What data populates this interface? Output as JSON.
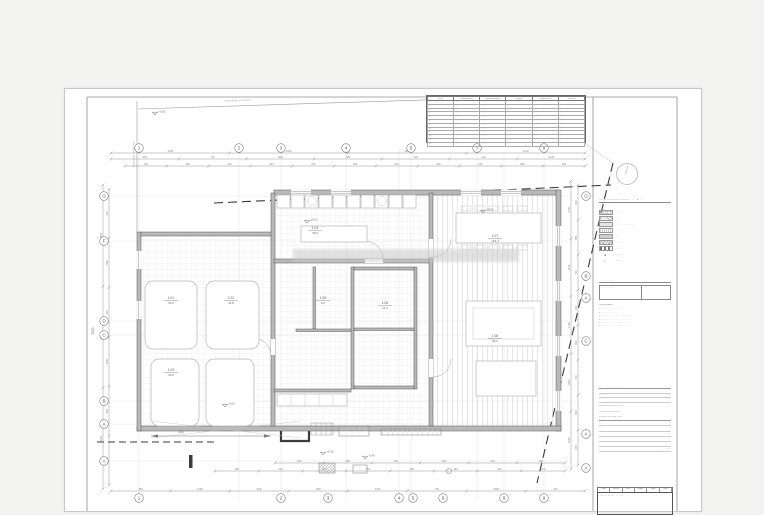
{
  "page": {
    "bg": "#f3f3f2",
    "sheet_bg": "#ffffff",
    "line_color": "#555555",
    "grid_color": "#dcdcdc",
    "dash_color": "#3a3a3a"
  },
  "plan": {
    "boundary_label": "граница участка",
    "grid": {
      "vlines": [
        74,
        174,
        216,
        281,
        334,
        346,
        412,
        439,
        479
      ],
      "hlines": [
        107,
        152,
        232,
        246,
        312,
        335,
        372
      ],
      "top": [
        {
          "x": 74,
          "label": "1"
        },
        {
          "x": 174,
          "label": "2"
        },
        {
          "x": 216,
          "label": "3"
        },
        {
          "x": 281,
          "label": "4"
        },
        {
          "x": 346,
          "label": "5"
        },
        {
          "x": 412,
          "label": "7"
        },
        {
          "x": 479,
          "label": "9"
        }
      ],
      "bottom": [
        {
          "x": 74,
          "label": "1"
        },
        {
          "x": 216,
          "label": "2"
        },
        {
          "x": 263,
          "label": "3"
        },
        {
          "x": 334,
          "label": "4"
        },
        {
          "x": 348,
          "label": "5"
        },
        {
          "x": 378,
          "label": "6"
        },
        {
          "x": 439,
          "label": "8"
        },
        {
          "x": 479,
          "label": "9"
        }
      ],
      "left": [
        {
          "y": 107,
          "label": "G"
        },
        {
          "y": 152,
          "label": "F"
        },
        {
          "y": 232,
          "label": "D"
        },
        {
          "y": 246,
          "label": "C"
        },
        {
          "y": 312,
          "label": "B"
        },
        {
          "y": 335,
          "label": "A"
        },
        {
          "y": 372,
          "label": "A"
        }
      ],
      "right": [
        {
          "y": 107,
          "label": "G"
        },
        {
          "y": 187,
          "label": "B"
        },
        {
          "y": 209,
          "label": "A"
        },
        {
          "y": 252,
          "label": "C"
        },
        {
          "y": 345,
          "label": "A"
        },
        {
          "y": 379,
          "label": "A"
        }
      ]
    },
    "dims": [
      {
        "o": "h",
        "y": 64,
        "x1": 46,
        "x2": 520,
        "vals": [
          "1245",
          "3300",
          "2890",
          "4120"
        ]
      },
      {
        "o": "h",
        "y": 70,
        "x1": 46,
        "x2": 520,
        "vals": [
          "350",
          "740",
          "1650",
          "830",
          "645",
          "410",
          "1245"
        ]
      },
      {
        "o": "h",
        "y": 77,
        "x1": 60,
        "x2": 520,
        "vals": [
          "120",
          "340",
          "510",
          "280",
          "420",
          "330",
          "510",
          "260",
          "340",
          "450",
          "300"
        ]
      },
      {
        "o": "h",
        "y": 374,
        "x1": 210,
        "x2": 500,
        "vals": [
          "420",
          "180",
          "260",
          "300",
          "240",
          "380"
        ]
      },
      {
        "o": "h",
        "y": 382,
        "x1": 150,
        "x2": 500,
        "vals": [
          "300",
          "510",
          "420",
          "360",
          "280",
          "440",
          "330",
          "270"
        ]
      },
      {
        "o": "h",
        "y": 402,
        "x1": 46,
        "x2": 520,
        "vals": [
          "980",
          "1460",
          "1020",
          "880",
          "1240",
          "760",
          "1080",
          "940"
        ]
      },
      {
        "o": "v",
        "x": 38,
        "y1": 96,
        "y2": 400,
        "vals": [
          "2850",
          "4320",
          "3940"
        ]
      },
      {
        "o": "v",
        "x": 44,
        "y1": 100,
        "y2": 396,
        "vals": [
          "760",
          "1180",
          "920",
          "1040",
          "860",
          "1120"
        ]
      },
      {
        "o": "v",
        "x": 506,
        "y1": 92,
        "y2": 380,
        "vals": [
          "1540",
          "2120",
          "1780",
          "1460",
          "1920"
        ]
      },
      {
        "o": "v",
        "x": 513,
        "y1": 96,
        "y2": 376,
        "vals": [
          "620",
          "880",
          "740",
          "810",
          "690",
          "720",
          "830",
          "650"
        ]
      }
    ],
    "special_dims": [
      {
        "x": 116,
        "y": 344,
        "label": "300",
        "rot": 0
      },
      {
        "x": 29,
        "y": 242,
        "label": "1500",
        "rot": -90
      }
    ],
    "rooms": [
      {
        "x": 106,
        "y": 210,
        "no": "1.01",
        "area": "35,2"
      },
      {
        "x": 166,
        "y": 210,
        "no": "1.02",
        "area": "34,8"
      },
      {
        "x": 106,
        "y": 282,
        "no": "1.03",
        "area": "33,6"
      },
      {
        "x": 250,
        "y": 140,
        "no": "1.04",
        "area": "38,6"
      },
      {
        "x": 258,
        "y": 210,
        "no": "1.05",
        "area": "6,2"
      },
      {
        "x": 320,
        "y": 215,
        "no": "1.06",
        "area": "12,4"
      },
      {
        "x": 430,
        "y": 148,
        "no": "1.07",
        "area": "164,4"
      },
      {
        "x": 430,
        "y": 248,
        "no": "1.08",
        "area": "56,0"
      }
    ],
    "elevations": [
      {
        "x": 90,
        "y": 26,
        "label": "+0,05"
      },
      {
        "x": 242,
        "y": 134,
        "label": "±0,00"
      },
      {
        "x": 418,
        "y": 124,
        "label": "±0,00"
      },
      {
        "x": 160,
        "y": 318,
        "label": "-0,02"
      },
      {
        "x": 258,
        "y": 366,
        "label": "+0,15"
      },
      {
        "x": 300,
        "y": 370,
        "label": "-0,45"
      }
    ]
  },
  "schedule": {
    "headers": [
      "——",
      "—————",
      "——————",
      "———",
      "—————",
      "———"
    ],
    "rows": [
      [
        "1",
        "······",
        "········",
        "···",
        "·····",
        "··"
      ],
      [
        "2",
        "······",
        "·········",
        "···",
        "·····",
        "··"
      ],
      [
        "3",
        "·····",
        "········",
        "···",
        "······",
        "··"
      ],
      [
        "4",
        "······",
        "·······",
        "···",
        "·····",
        "··"
      ],
      [
        "5",
        "······",
        "·········",
        "···",
        "·····",
        "··"
      ],
      [
        "6",
        "·····",
        "········",
        "···",
        "······",
        "··"
      ],
      [
        "7",
        "······",
        "········",
        "···",
        "·····",
        "··"
      ],
      [
        "8",
        "······",
        "·········",
        "···",
        "·····",
        "··"
      ],
      [
        "9",
        "·····",
        "·······",
        "···",
        "······",
        "··"
      ],
      [
        "10",
        "······",
        "········",
        "···",
        "·····",
        "··"
      ],
      [
        "11",
        "······",
        "········",
        "···",
        "·····",
        "··"
      ],
      [
        "12",
        "·····",
        "·········",
        "···",
        "·····",
        "··"
      ]
    ]
  },
  "legend": {
    "title": "—————— ———, ···· + ····",
    "subtitle": "··· ·· ········ ·····",
    "items": [
      {
        "hatch": "hatch-grid",
        "label": "·········"
      },
      {
        "hatch": "hatch-diag",
        "label": "······"
      },
      {
        "hatch": "hatch-dots",
        "label": "···· ···· ····· · ·········"
      },
      {
        "hatch": "hatch-vert",
        "label": "··········"
      },
      {
        "hatch": "hatch-solid",
        "label": "·····"
      },
      {
        "hatch": "hatch-cross",
        "label": "···· ·····"
      },
      {
        "hatch": "hatch-dash",
        "label": "······ ····"
      }
    ],
    "extras": [
      {
        "symbol": "◄",
        "label": "··· — ·······"
      },
      {
        "symbol": "⌖",
        "label": "··· — ·····"
      }
    ]
  },
  "sample": {
    "line": "··· ········ ·····",
    "left": "···· ·········",
    "right": "·····"
  },
  "notes": {
    "heading": "Примечания:",
    "items": [
      "1. ······ ········ · ··· ·····",
      "2. ········· ···· · ·· ···",
      "3. ······· ········· ···· ······ ·· ········",
      "4. ····· ···· ····· ······ · ········ ·· ····",
      "5. ········· · ········ ····· ··· ·· ······",
      "6. ······ ······ ·· ····· — ··· ····"
    ]
  },
  "titleblock": {
    "header": "····· ········· ···· ····· · ····",
    "rows": [
      {
        "l": "·······",
        "v": "·"
      },
      {
        "l": "········ ···",
        "v": "·"
      },
      {
        "l": "····· ······",
        "v": "·"
      }
    ],
    "address": [
      "············ ········ ·····",
      "··· ··········· ···· ····",
      "· ······· ···· ····· ·····"
    ],
    "mini": [
      {
        "l": "···",
        "v": "···· ·····"
      },
      {
        "l": "·······",
        "v": "·· · ····"
      },
      {
        "l": "··",
        "v": "·· · ·····"
      },
      {
        "l": "··",
        "v": "·· · ·····"
      },
      {
        "l": "··",
        "v": "·· ··· ····"
      },
      {
        "l": "··",
        "v": "··· ·······"
      }
    ]
  },
  "stamp": {
    "cols": [
      "Изм.",
      "Кол.уч",
      "Лист",
      "№док.",
      "Подп.",
      "Дата"
    ],
    "title": "··········· · ····"
  }
}
